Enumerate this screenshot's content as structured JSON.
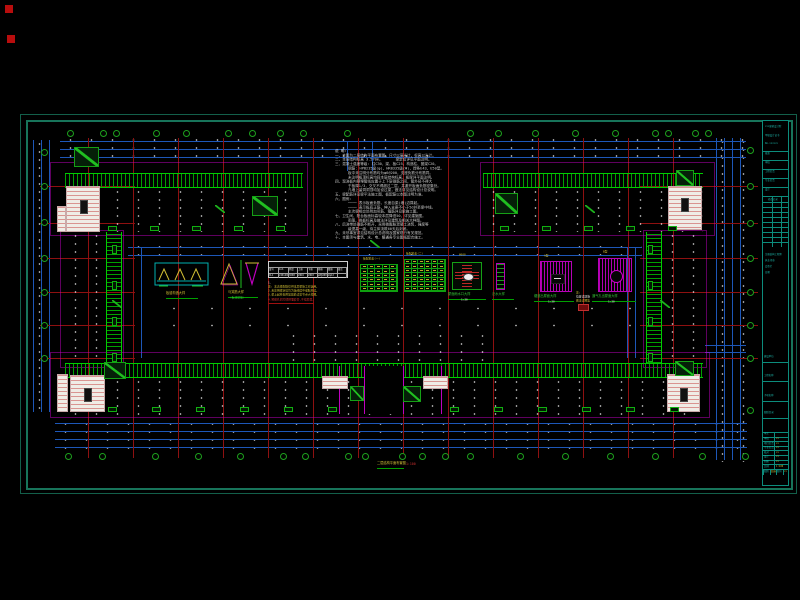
{
  "colors": {
    "bg": "#000000",
    "frame": "#17745a",
    "dim_blue": "#1d57b8",
    "hatch_green": "#00a000",
    "grid_red": "#8e1010",
    "magenta": "#c000c0",
    "label_yellow": "#d0be34",
    "note_white": "#c9c9c9",
    "strip_cyan": "#1fbdb0"
  },
  "notes": {
    "title": "说 明:",
    "lines": [
      "一、本图为二层结构平面布置图，尺寸以毫米计，标高以米计。",
      "二、本层结构标高 3.570m。      梁定位详见平面注明。",
      "三、混凝土强度等级: 柱C30，梁、板C25，构造柱、圈梁C20。",
      "      钢筋: HPB235级(φ)、HRB335级(Φ)，焊条E43、E50型。",
      "      板中未注明分布筋均为φ6@200，支座负筋分布筋同。",
      "      未注明板顶标高均同本层结构标高，板厚详平面注明。",
      "四、现浇板内预埋管线应置于上下层钢筋之间，管外径不得大",
      "      于板厚1/3，交叉不得超过二层，并避开板面负筋密集处。",
      "      凡墙上留洞洞顶均加设过梁，做法详见结构设计总说明。",
      "五、梁配筋详见梁平法施工图，板配筋以本图注明为准。",
      "六、图例:",
      "      ──── 表示板面负筋，长度自梁(墙)边算起。",
      "      ──── 表示板底正筋，伸入支座不小于5d并至梁中线。",
      "      主次梁相交处附加吊筋、箍筋详见梁施工图。",
      "七、卫生间、阳台板面标高较本层降低50，详见建施图。",
      "      雨篷、挑板标高及做法详见建筑及相关大样图。",
      "八、后浇带处钢筋不断开，采用微膨胀混凝土浇筑，强度等",
      "      级提高一级，待主体浇筑60天后封闭。",
      "九、未尽事宜详见结构设计总说明及国家现行有关规范。",
      "十、本图须与建筑、水、电、暖通各专业图纸配合施工。"
    ]
  },
  "details": {
    "d1": {
      "label": "板缝构造大样"
    },
    "d2": {
      "label1": "马凳筋大样",
      "label2": "(板双层筋)"
    },
    "table": {
      "title": "现 浇 梁 表",
      "headers": [
        "梁号",
        "b×h",
        "跨度",
        "上筋",
        "下筋",
        "箍筋",
        "腰筋",
        "备注"
      ],
      "row": [
        "XL1",
        "240×400",
        "3600",
        "2Φ16",
        "2Φ18",
        "φ8@200",
        "2φ12",
        ""
      ],
      "notes": [
        "1.",
        "注: 本表梁配筋仅供本层梁施工时选用。",
        "2.未注明梁定位均为轴线居中或贴柱边。",
        "3.梁上起柱处附加箍筋详见节点大样图。"
      ],
      "note_red": "4.预留孔洞均须预埋套管,不得后凿。"
    },
    "gt1": {
      "title": "板配筋表(一)",
      "rows": 6,
      "cols": 5
    },
    "gt2": {
      "title": "板配筋表(二)",
      "rows": 7,
      "cols": 6
    },
    "d6": {
      "top": "Ø600",
      "label": "屋面雨水口大样",
      "sub": "1:20"
    },
    "d7": {
      "label": "泛水大样"
    },
    "d8": {
      "top": "A型",
      "label": "烟道出屋面大样",
      "sub": "1:20"
    },
    "mid_note": {
      "l1": "注:",
      "l2": "位置详建施",
      "l3": "做法详图集"
    },
    "d9": {
      "top": "B型",
      "label": "通气孔出屋面大样",
      "sub": "1:20"
    }
  },
  "drawing_title": {
    "text": "二层结构平面布置图",
    "scale": "1:100"
  },
  "titleblock": {
    "firm": "×××建筑设计院",
    "firm2": "甲级设计证书",
    "firm3": "No.××××××",
    "mid_rows": [
      "批准",
      "审核",
      "工程负责",
      "专业负责",
      "设计"
    ],
    "rev_header": "修改记录",
    "rev_rows": 9,
    "cert_lines": [
      "注册结构工程师",
      "执业印章",
      "会签栏",
      "日期"
    ],
    "section_labels": [
      "建设单位",
      "工程名称",
      "子项名称",
      "图纸目录"
    ],
    "bt_rows": [
      [
        "审定",
        ""
      ],
      [
        "审核",
        "××"
      ],
      [
        "项目负责",
        "××"
      ],
      [
        "专业负责",
        "××"
      ],
      [
        "校对",
        "××"
      ],
      [
        "设计",
        "××"
      ],
      [
        "制图",
        "××"
      ],
      [
        "比例",
        "1:100"
      ]
    ],
    "bottom_cells": [
      "图别",
      "结施",
      "图号",
      "××"
    ]
  },
  "plan": {
    "frame": {
      "outer": [
        20,
        114,
        775,
        378
      ],
      "inner": [
        26,
        120,
        763,
        366
      ]
    },
    "strip": {
      "x": 762,
      "y": 120,
      "w": 27,
      "h": 366
    },
    "red_squares": [
      [
        5,
        5,
        8,
        8
      ],
      [
        7,
        35,
        8,
        8
      ]
    ],
    "red_v": [
      88,
      133,
      178,
      223,
      268,
      313,
      358,
      403,
      448,
      493,
      538,
      583,
      628,
      673
    ],
    "red_v_y": [
      138,
      458
    ],
    "red_h": [
      186,
      223,
      258,
      292,
      325,
      358
    ],
    "red_h_seg": [
      [
        40,
        135
      ],
      [
        640,
        758
      ]
    ],
    "dims_h": [
      [
        60,
        141,
        686
      ],
      [
        60,
        149,
        686
      ],
      [
        60,
        157,
        686
      ],
      [
        55,
        423,
        692
      ],
      [
        55,
        431,
        692
      ],
      [
        55,
        439,
        692
      ],
      [
        55,
        447,
        692
      ],
      [
        128,
        247,
        514
      ],
      [
        128,
        255,
        514
      ],
      [
        705,
        345,
        41
      ],
      [
        705,
        352,
        41
      ]
    ],
    "dims_v": [
      [
        33,
        140,
        272
      ],
      [
        41,
        140,
        272
      ],
      [
        49,
        140,
        272
      ],
      [
        716,
        138,
        322
      ],
      [
        724,
        138,
        322
      ],
      [
        732,
        138,
        322
      ],
      [
        740,
        138,
        322
      ],
      [
        133,
        247,
        111
      ],
      [
        141,
        247,
        111
      ],
      [
        627,
        247,
        111
      ],
      [
        635,
        247,
        111
      ],
      [
        347,
        141,
        30
      ],
      [
        372,
        141,
        30
      ]
    ],
    "specks": [
      [
        60,
        136,
        686,
        26,
        0
      ],
      [
        55,
        420,
        692,
        30,
        0
      ],
      [
        29,
        140,
        28,
        274,
        0
      ],
      [
        712,
        138,
        34,
        324,
        0
      ],
      [
        128,
        243,
        514,
        16,
        0
      ],
      [
        155,
        300,
        480,
        34,
        1
      ]
    ],
    "bubbles_top": {
      "y": 133,
      "x": [
        70,
        103,
        116,
        156,
        186,
        228,
        252,
        280,
        303,
        347,
        470,
        498,
        535,
        575,
        615,
        655,
        668,
        695,
        708
      ]
    },
    "bubbles_bottom": {
      "y": 456,
      "x": [
        68,
        102,
        155,
        198,
        240,
        283,
        305,
        348,
        365,
        402,
        422,
        445,
        470,
        520,
        565,
        610,
        655,
        702,
        745
      ]
    },
    "bubbles_left": {
      "x": 44,
      "y": [
        152,
        186,
        222,
        258,
        292,
        325,
        358
      ]
    },
    "bubbles_right": {
      "x": 750,
      "y": [
        150,
        186,
        223,
        258,
        292,
        325,
        358,
        410
      ]
    },
    "outlines": [
      [
        50,
        162,
        258,
        74
      ],
      [
        480,
        162,
        235,
        74
      ],
      [
        60,
        230,
        64,
        138
      ],
      [
        643,
        230,
        64,
        138
      ],
      [
        50,
        352,
        660,
        66
      ]
    ],
    "wings": [
      {
        "x": 65,
        "y": 173,
        "w": 238,
        "h": 59,
        "t": "h-top"
      },
      {
        "x": 483,
        "y": 173,
        "w": 220,
        "h": 59,
        "t": "h-top"
      },
      {
        "x": 65,
        "y": 232,
        "w": 57,
        "h": 131,
        "t": "v-right"
      },
      {
        "x": 646,
        "y": 232,
        "w": 57,
        "h": 131,
        "t": "v-left"
      },
      {
        "x": 65,
        "y": 363,
        "w": 638,
        "h": 52,
        "t": "h-top"
      },
      {
        "x": 283,
        "y": 332,
        "w": 214,
        "h": 31,
        "t": "plain"
      }
    ],
    "stairs": [
      [
        66,
        186,
        34,
        46
      ],
      [
        57,
        206,
        9,
        26
      ],
      [
        668,
        186,
        34,
        44
      ],
      [
        70,
        375,
        35,
        37
      ],
      [
        57,
        374,
        11,
        38
      ],
      [
        667,
        374,
        33,
        38
      ],
      [
        322,
        376,
        26,
        13
      ],
      [
        423,
        376,
        25,
        13
      ]
    ],
    "slopes": [
      [
        74,
        147,
        25,
        20
      ],
      [
        252,
        196,
        26,
        20
      ],
      [
        495,
        193,
        23,
        21
      ],
      [
        676,
        170,
        18,
        16
      ],
      [
        104,
        362,
        22,
        17
      ],
      [
        675,
        361,
        19,
        15
      ],
      [
        350,
        386,
        14,
        15
      ],
      [
        403,
        386,
        18,
        16
      ]
    ],
    "diag_marks": [
      [
        215,
        205
      ],
      [
        585,
        205
      ],
      [
        112,
        300
      ],
      [
        660,
        300
      ],
      [
        370,
        240
      ]
    ],
    "entrance": {
      "gap": [
        364,
        366,
        39,
        48
      ],
      "mag_x": [
        339,
        364,
        403,
        441
      ],
      "mag_y": [
        366,
        48
      ]
    },
    "mark_rows": [
      [
        226,
        108,
        292,
        42
      ],
      [
        226,
        500,
        690,
        42
      ],
      [
        407,
        108,
        330,
        44
      ],
      [
        407,
        450,
        690,
        44
      ]
    ],
    "mark_cols": [
      [
        112,
        245,
        355,
        36
      ],
      [
        648,
        245,
        355,
        36
      ]
    ]
  }
}
